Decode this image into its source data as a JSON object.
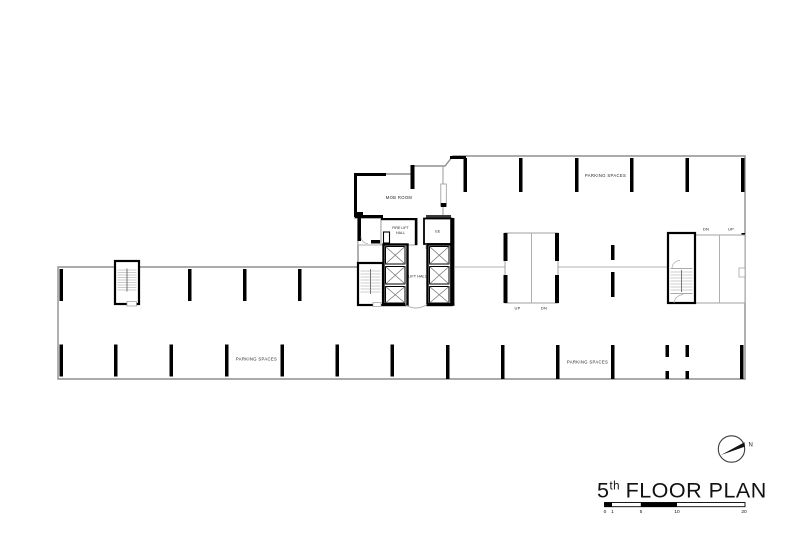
{
  "plan": {
    "core": {
      "mob_room": "MOB ROOM",
      "fire_lift_hall_line1": "FIRE LIFT",
      "fire_lift_hall_line2": "HALL",
      "ee_room": "EE",
      "lift_hall": "LIFT HALL"
    },
    "parking": {
      "top_label": "PARKING SPACES",
      "bottom_left_label": "PARKING SPACES",
      "bottom_right_label": "PARKING SPACES"
    },
    "ramps": {
      "center_left_lane": "UP",
      "center_right_lane": "DN",
      "right_left_lane": "DN",
      "right_right_lane": "UP"
    },
    "north_arrow": {
      "label": "N"
    }
  },
  "title_block": {
    "floor_number": "5",
    "ordinal_suffix": "th",
    "title_text": "FLOOR PLAN",
    "scale_ticks": [
      "0",
      "1",
      "5",
      "10",
      "20"
    ]
  },
  "colors": {
    "wall": "#000000",
    "thin_line": "#9a9a9a",
    "background": "#ffffff"
  }
}
